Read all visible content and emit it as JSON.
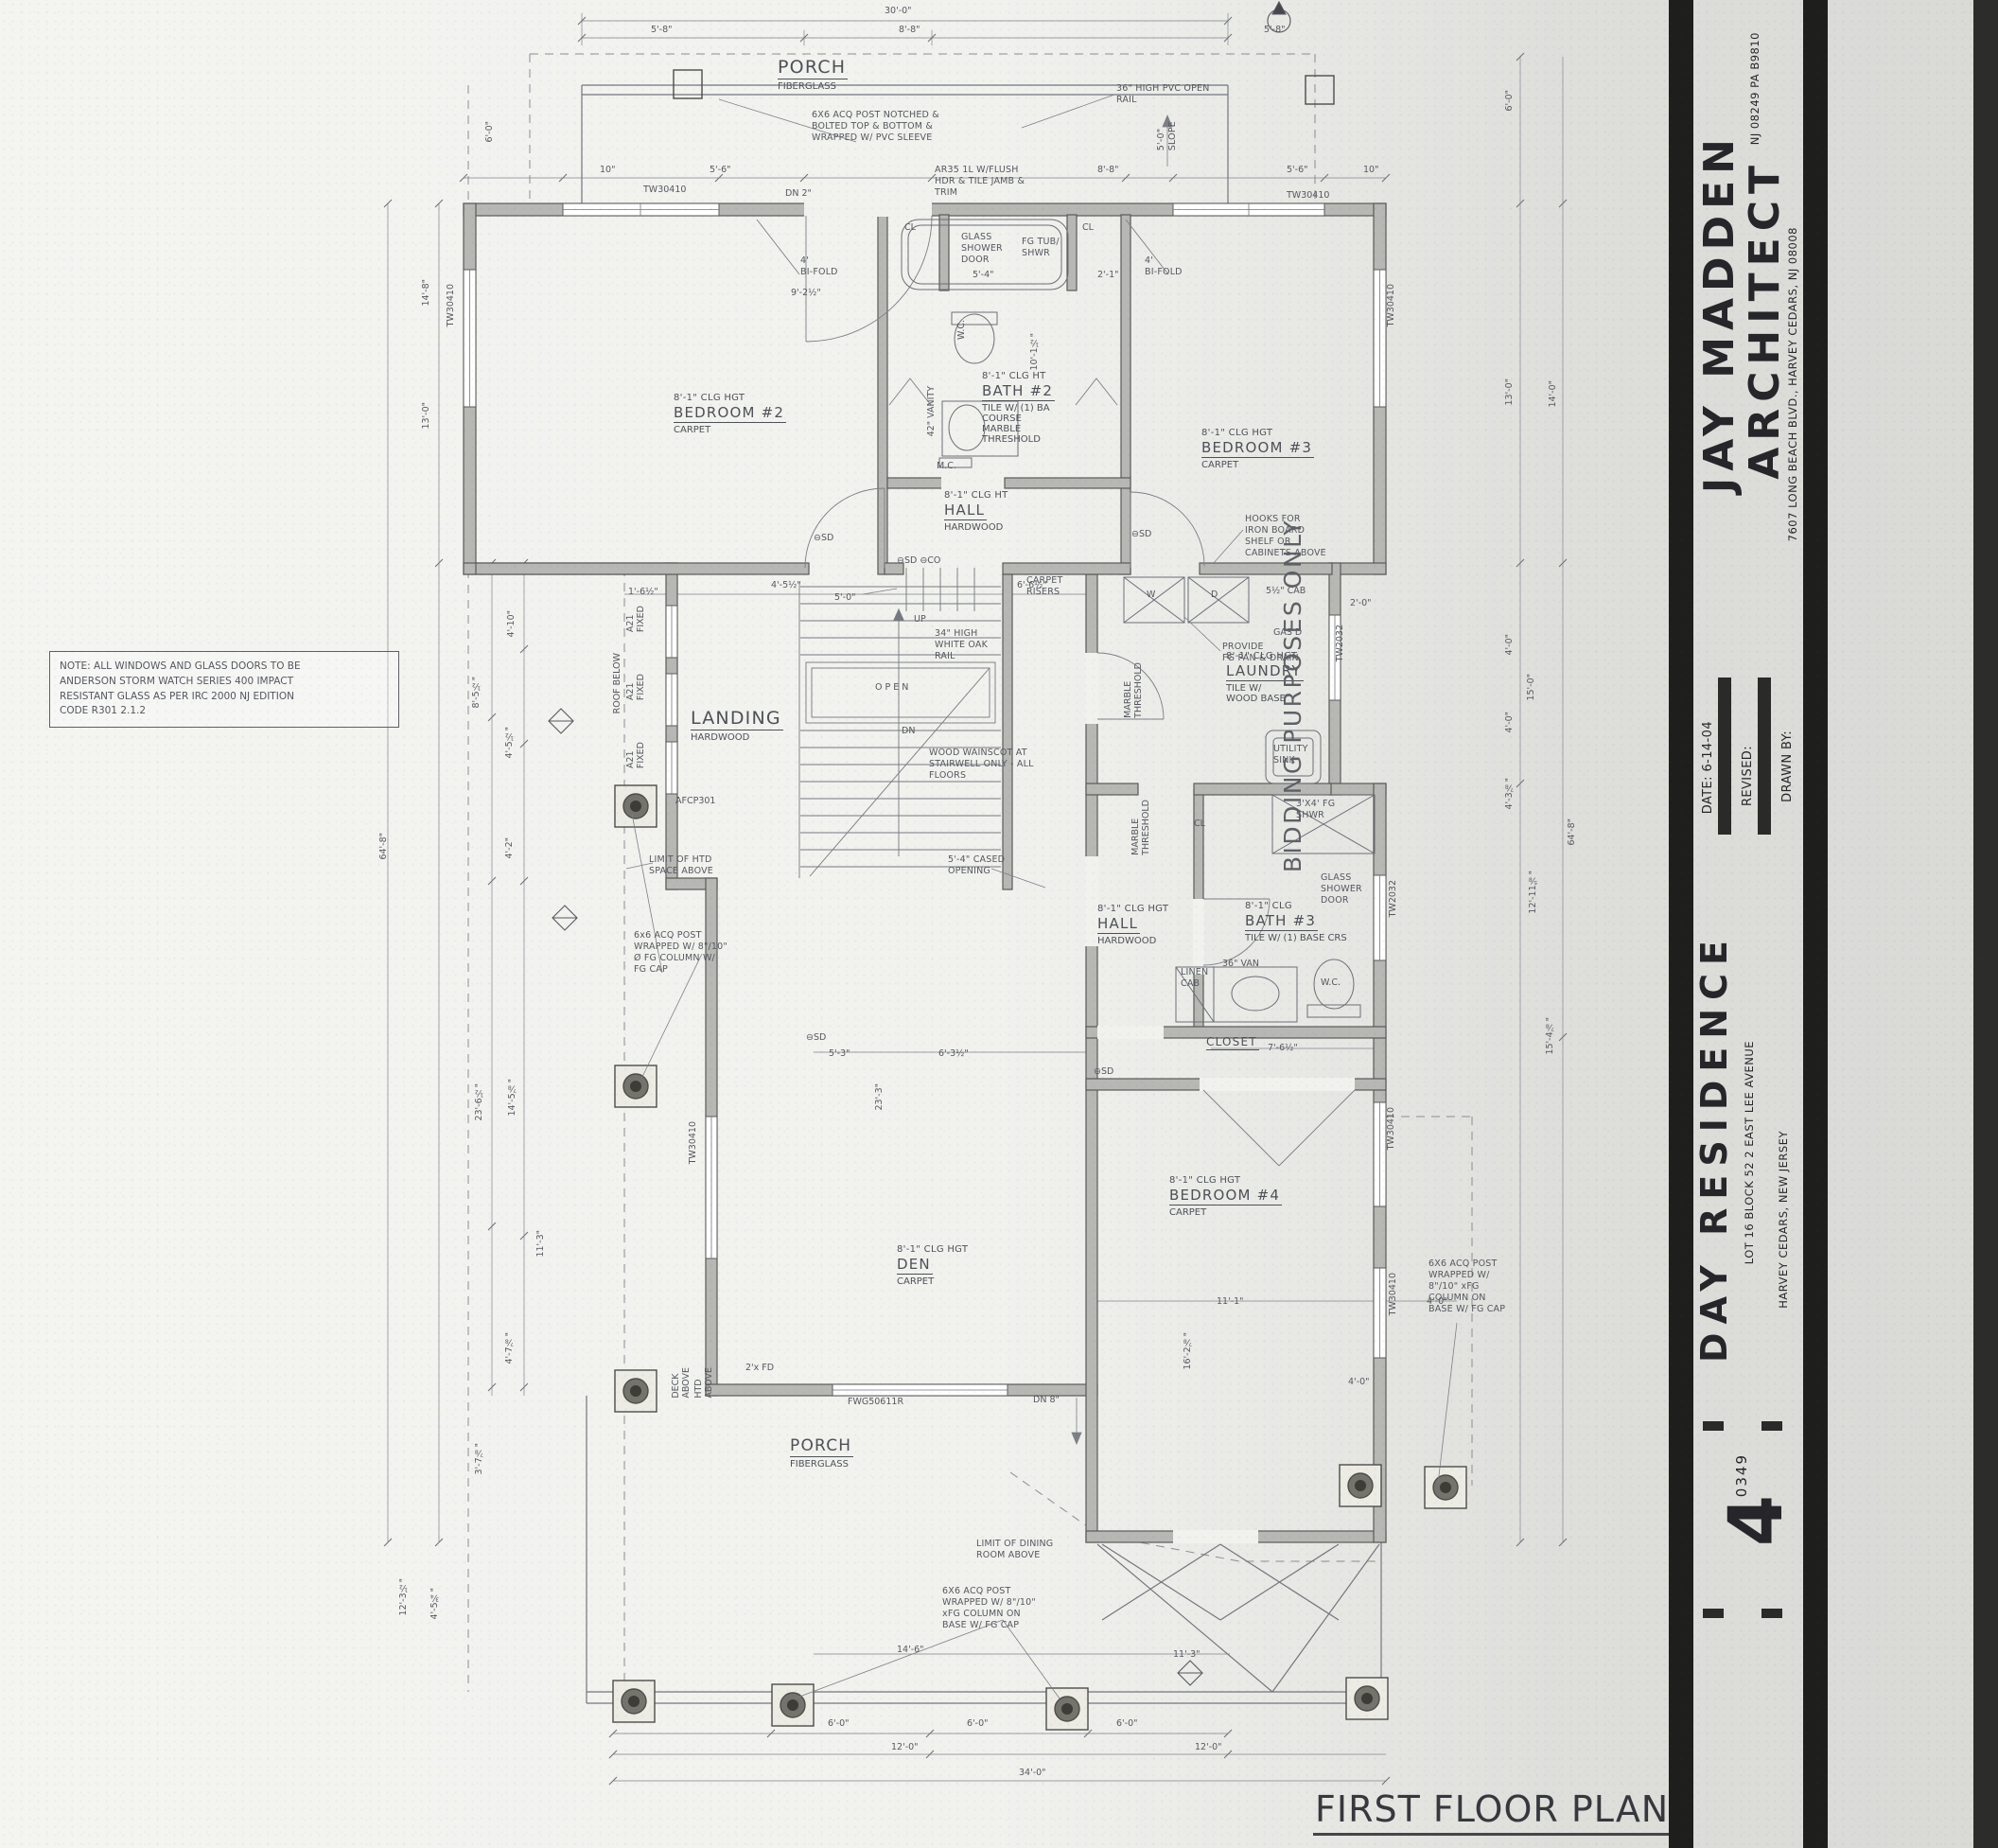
{
  "plan_title": "FIRST FLOOR PLAN",
  "stamp": "BIDDING PURPOSES ONLY",
  "note": "NOTE: ALL WINDOWS AND GLASS DOORS TO BE\nANDERSON STORM WATCH SERIES 400 IMPACT\nRESISTANT GLASS AS PER IRC 2000 NJ EDITION\nCODE R301 2.1.2",
  "title_block": {
    "firm_line1": "JAY MADDEN",
    "firm_line2": "ARCHITECT",
    "license": "NJ 08249   PA B9810",
    "firm_address": "7607 LONG BEACH BLVD., HARVEY CEDARS, NJ  08008",
    "date_label": "DATE:   6-14-04",
    "revised_label": "REVISED:",
    "drawn_by_label": "DRAWN BY:",
    "project_name": "DAY RESIDENCE",
    "project_address": "LOT 16  BLOCK 52   2 EAST LEE AVENUE",
    "project_city": "HARVEY CEDARS, NEW JERSEY",
    "job_number": "0349",
    "sheet_number": "4"
  },
  "rooms": [
    {
      "clg": "8'-1\" CLG HGT",
      "name": "BEDROOM #2",
      "floor": "CARPET"
    },
    {
      "clg": "8'-1\" CLG HT",
      "name": "BATH #2",
      "floor": "TILE W/ (1) BA\nCOURSE\nMARBLE\nTHRESHOLD"
    },
    {
      "clg": "8'-1\" CLG HGT",
      "name": "BEDROOM #3",
      "floor": "CARPET"
    },
    {
      "clg": "8'-1\" CLG HT",
      "name": "HALL",
      "floor": "HARDWOOD"
    },
    {
      "name": "LANDING",
      "floor": "HARDWOOD"
    },
    {
      "clg": "8'-1\" CLG HGT",
      "name": "LAUNDRY",
      "floor": "TILE W/\nWOOD BASE"
    },
    {
      "clg": "8'-1\" CLG HGT",
      "name": "HALL",
      "floor": "HARDWOOD"
    },
    {
      "clg": "8'-1\" CLG",
      "name": "BATH #3",
      "floor": "TILE W/ (1) BASE CRS"
    },
    {
      "name": "CLOSET"
    },
    {
      "clg": "8'-1\" CLG HGT",
      "name": "BEDROOM #4",
      "floor": "CARPET"
    },
    {
      "clg": "8'-1\" CLG HGT",
      "name": "DEN",
      "floor": "CARPET"
    },
    {
      "name": "PORCH",
      "floor": "FIBERGLASS"
    },
    {
      "name": "PORCH",
      "floor": "FIBERGLASS"
    }
  ],
  "annotations": [
    "6X6 ACQ POST NOTCHED &\nBOLTED TOP & BOTTOM &\nWRAPPED W/ PVC SLEEVE",
    "36\" HIGH PVC OPEN\nRAIL",
    "5'-0\"\nSLOPE",
    "AR35 1L W/FLUSH\nHDR & TILE JAMB &\nTRIM",
    "GLASS\nSHOWER\nDOOR",
    "FG TUB/\nSHWR",
    "4'\nBI-FOLD",
    "4'\nBI-FOLD",
    "HOOKS FOR\nIRON BOARD\nSHELF OR\nCABINETS ABOVE",
    "CARPET\nRISERS",
    "34\" HIGH\nWHITE OAK\nRAIL",
    "WOOD WAINSCOT AT\nSTAIRWELL ONLY - ALL\nFLOORS",
    "5'-4\" CASED\nOPENING",
    "LIMIT OF HTD\nSPACE ABOVE",
    "6x6 ACQ POST\nWRAPPED W/ 8\"/10\"\nØ FG COLUMN W/\nFG CAP",
    "PROVIDE\nFG PAN & DRAIN",
    "UTILITY\nSINK",
    "3'X4' FG\nSHWR",
    "GLASS\nSHOWER\nDOOR",
    "LINEN\nCAB",
    "LIMIT OF DINING\nROOM ABOVE",
    "6X6 ACQ POST\nWRAPPED W/ 8\"/10\"\nxFG COLUMN ON\nBASE W/ FG CAP",
    "6X6 ACQ POST\nWRAPPED W/\n8\"/10\" xFG\nCOLUMN ON\nBASE W/ FG CAP"
  ],
  "tags": [
    "TW30410",
    "TW30410",
    "TW30410",
    "TW30410",
    "TW30410",
    "TW2032",
    "TW2032",
    "TW30410",
    "TW30410",
    "A21\nFIXED",
    "A21\nFIXED",
    "A21\nFIXED",
    "AFCP301",
    "⊖SD",
    "⊖SD ⊖CO",
    "⊖SD",
    "⊖SD",
    "⊖SD",
    "OPEN",
    "UP",
    "DN",
    "W",
    "D",
    "CL",
    "CL",
    "CL",
    "W.C.",
    "W.C.",
    "M.C.",
    "FWG50611R",
    "DN 8\"",
    "DN 2\"",
    "36\" VAN",
    "42\" VANITY",
    "GAS D",
    "5½\" CAB",
    "ROOF BELOW",
    "DECK\nABOVE",
    "HTD\nABOVE",
    "2'x FD",
    "MARBLE\nTHRESHOLD",
    "MARBLE\nTHRESHOLD"
  ],
  "dims": [
    "30'-0\"",
    "5'-8\"",
    "8'-8\"",
    "5'-8\"",
    "6'-0\"",
    "10\"",
    "5'-6\"",
    "8'-8\"",
    "5'-6\"",
    "10\"",
    "9'-2½\"",
    "5'-4\"",
    "2'-1\"",
    "14'-8\"",
    "13'-0\"",
    "64'-8\"",
    "8'-5½\"",
    "4'-10\"",
    "4'-5½\"",
    "4'-2\"",
    "23'-6½\"",
    "14'-5⅞\"",
    "11'-3\"",
    "4'-7⅞\"",
    "3'-7⅞\"",
    "12'-3½\"",
    "4'-5¾\"",
    "5'-3\"",
    "23'-3\"",
    "6'-3½\"",
    "16'-2⅞\"",
    "11'-1\"",
    "4'-0\"",
    "6'-0\"",
    "6'-0\"",
    "6'-0\"",
    "12'-0\"",
    "12'-0\"",
    "34'-0\"",
    "14'-6\"",
    "11'-3\"",
    "6'-0\"",
    "13'-0\"",
    "14'-0\"",
    "4'-0\"",
    "15'-0\"",
    "4'-0\"",
    "4'-3⅞\"",
    "12'-11⅝\"",
    "15'-4⅞\"",
    "64'-8\"",
    "6'-6½\"",
    "4'-5½\"",
    "1'-6½\"",
    "5'-0\"",
    "2'-0\"",
    "7'-6½\"",
    "10'-1½\"",
    "4'-0\""
  ]
}
